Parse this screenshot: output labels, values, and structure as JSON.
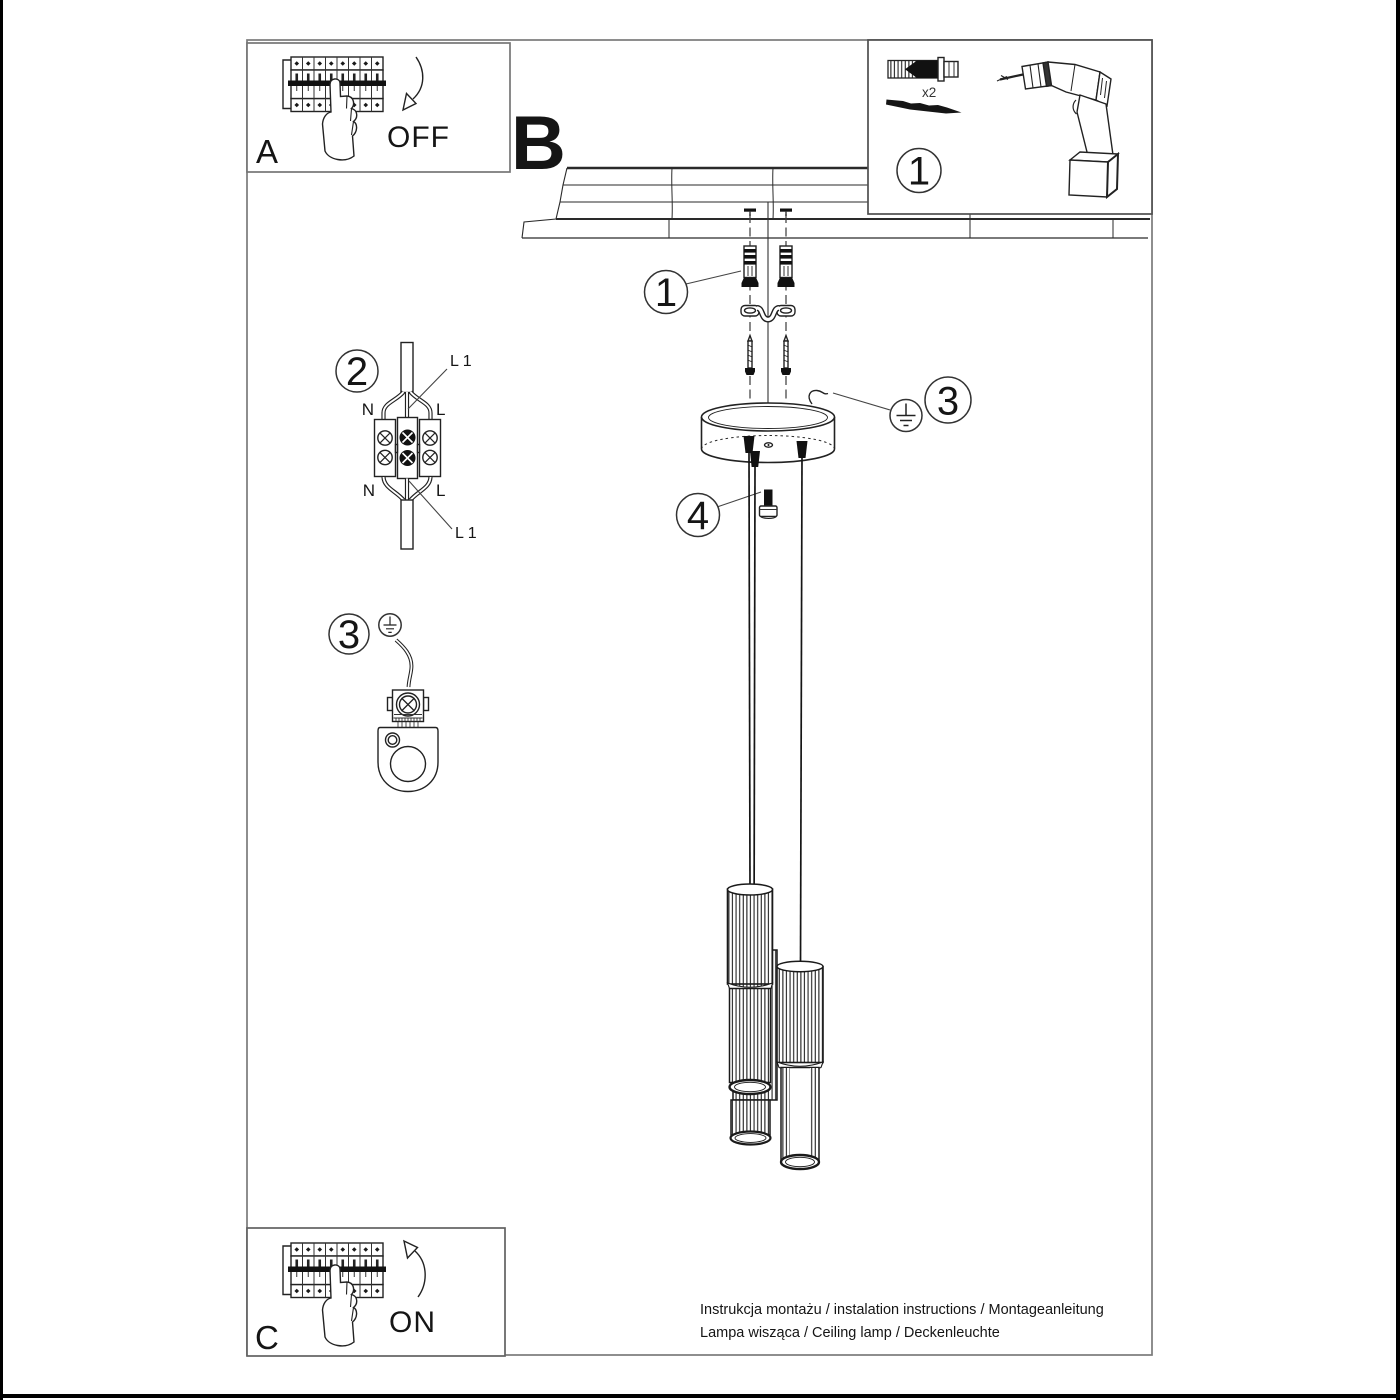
{
  "document": {
    "type": "lamp-installation-instruction-sheet",
    "background": "#ffffff",
    "ink_color": "#222222",
    "frame_color": "#7a7a7a"
  },
  "sections": {
    "power_off": {
      "label": "A",
      "state": "OFF"
    },
    "main_view": {
      "label": "B"
    },
    "power_on": {
      "label": "C",
      "state": "ON"
    }
  },
  "tools_panel": {
    "callout": "1",
    "anchor_count": "x2"
  },
  "callouts": {
    "wall_anchors": "1",
    "terminal_block": "2",
    "ground_wire": "3",
    "ground_terminal_detail": "3",
    "grub_screw": "4"
  },
  "wiring_labels": {
    "top_cable": "L 1",
    "bottom_cable": "L 1",
    "neutral_top": "N",
    "live_top": "L",
    "neutral_bottom": "N",
    "live_bottom": "L"
  },
  "footer": {
    "line1": "Instrukcja montażu / instalation instructions / Montageanleitung",
    "line2": "Lampa wisząca / Ceiling lamp / Deckenleuchte"
  }
}
